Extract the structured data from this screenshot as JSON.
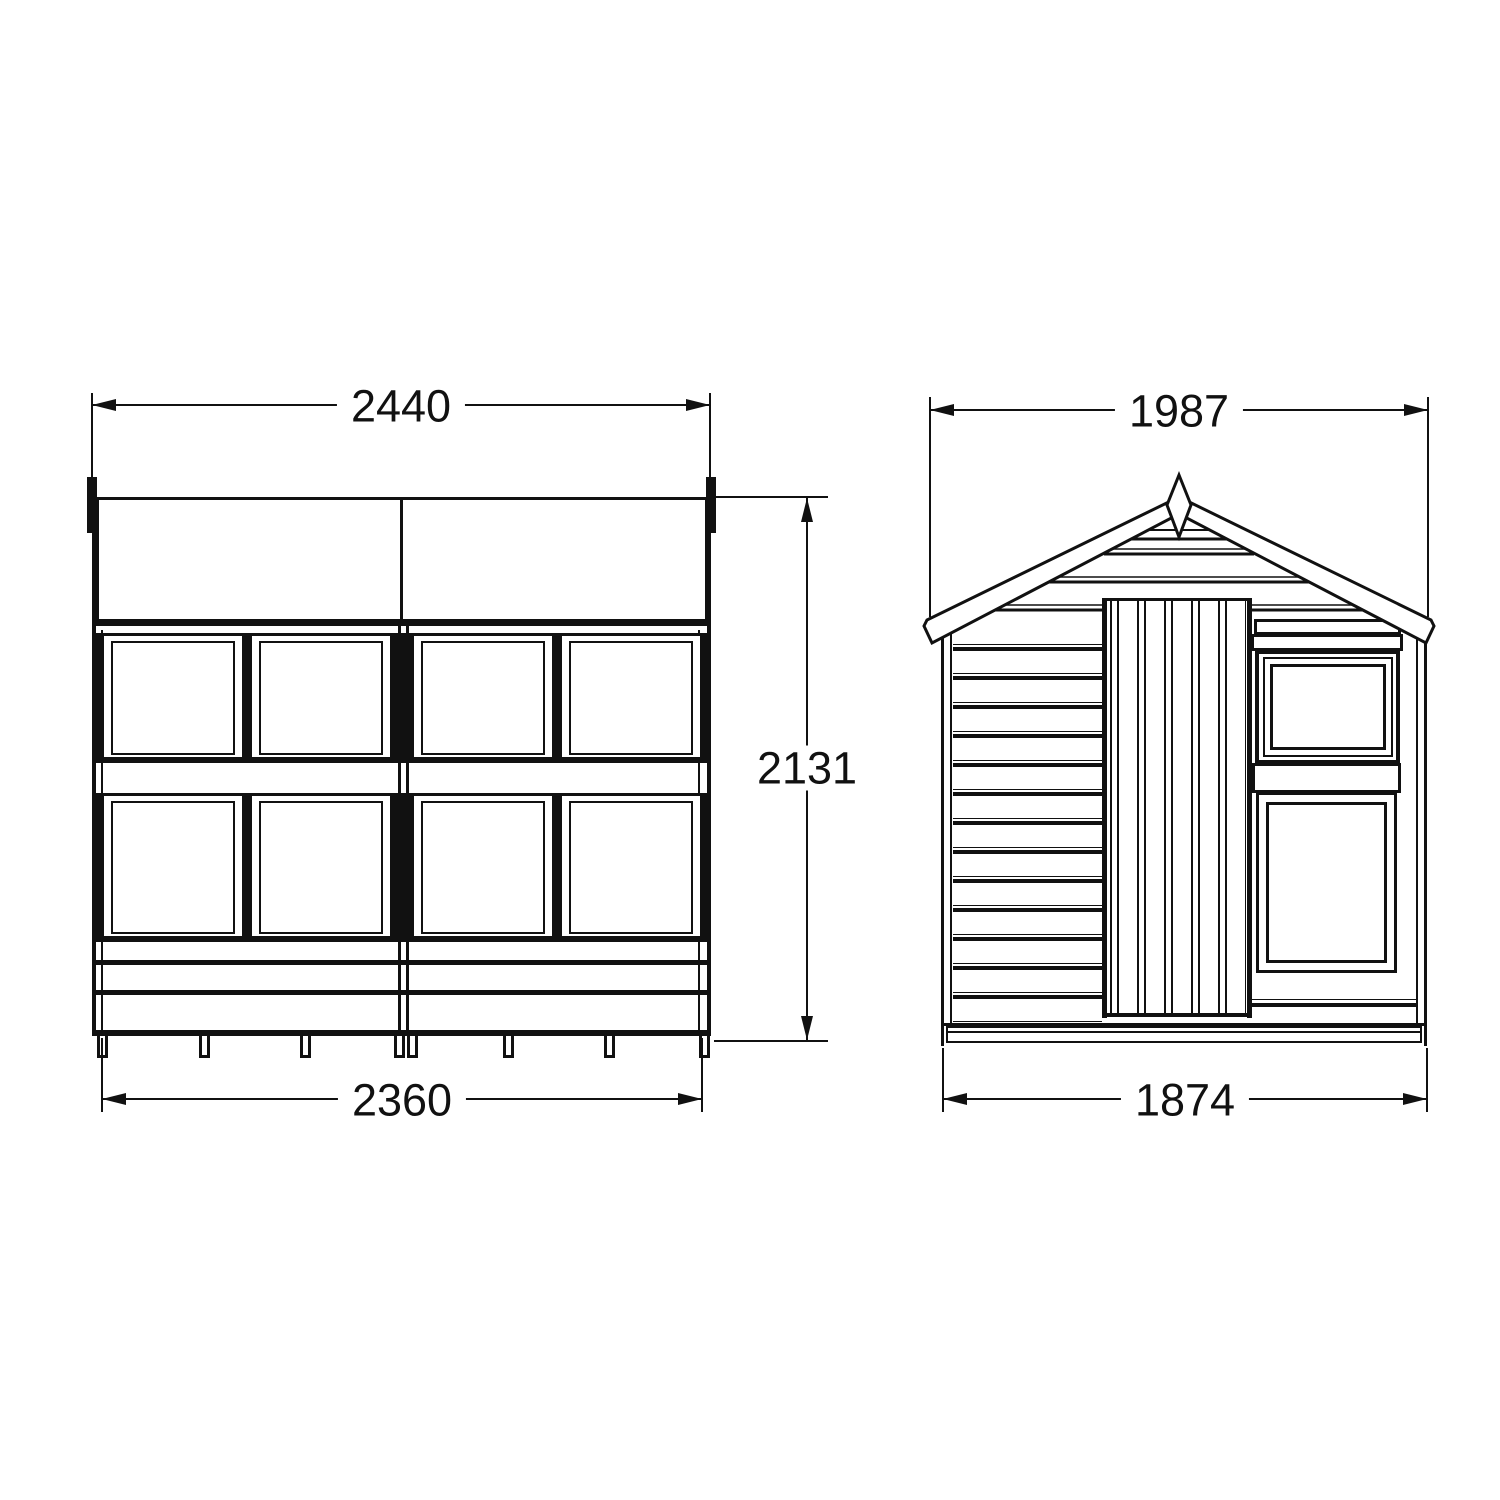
{
  "colors": {
    "ink": "#111111",
    "paper": "#ffffff"
  },
  "views": {
    "side": {
      "name": "side-elevation",
      "dims": {
        "top": "2440",
        "height": "2131",
        "bottom": "2360"
      }
    },
    "front": {
      "name": "front-elevation",
      "dims": {
        "top": "1987",
        "bottom": "1874"
      }
    }
  }
}
